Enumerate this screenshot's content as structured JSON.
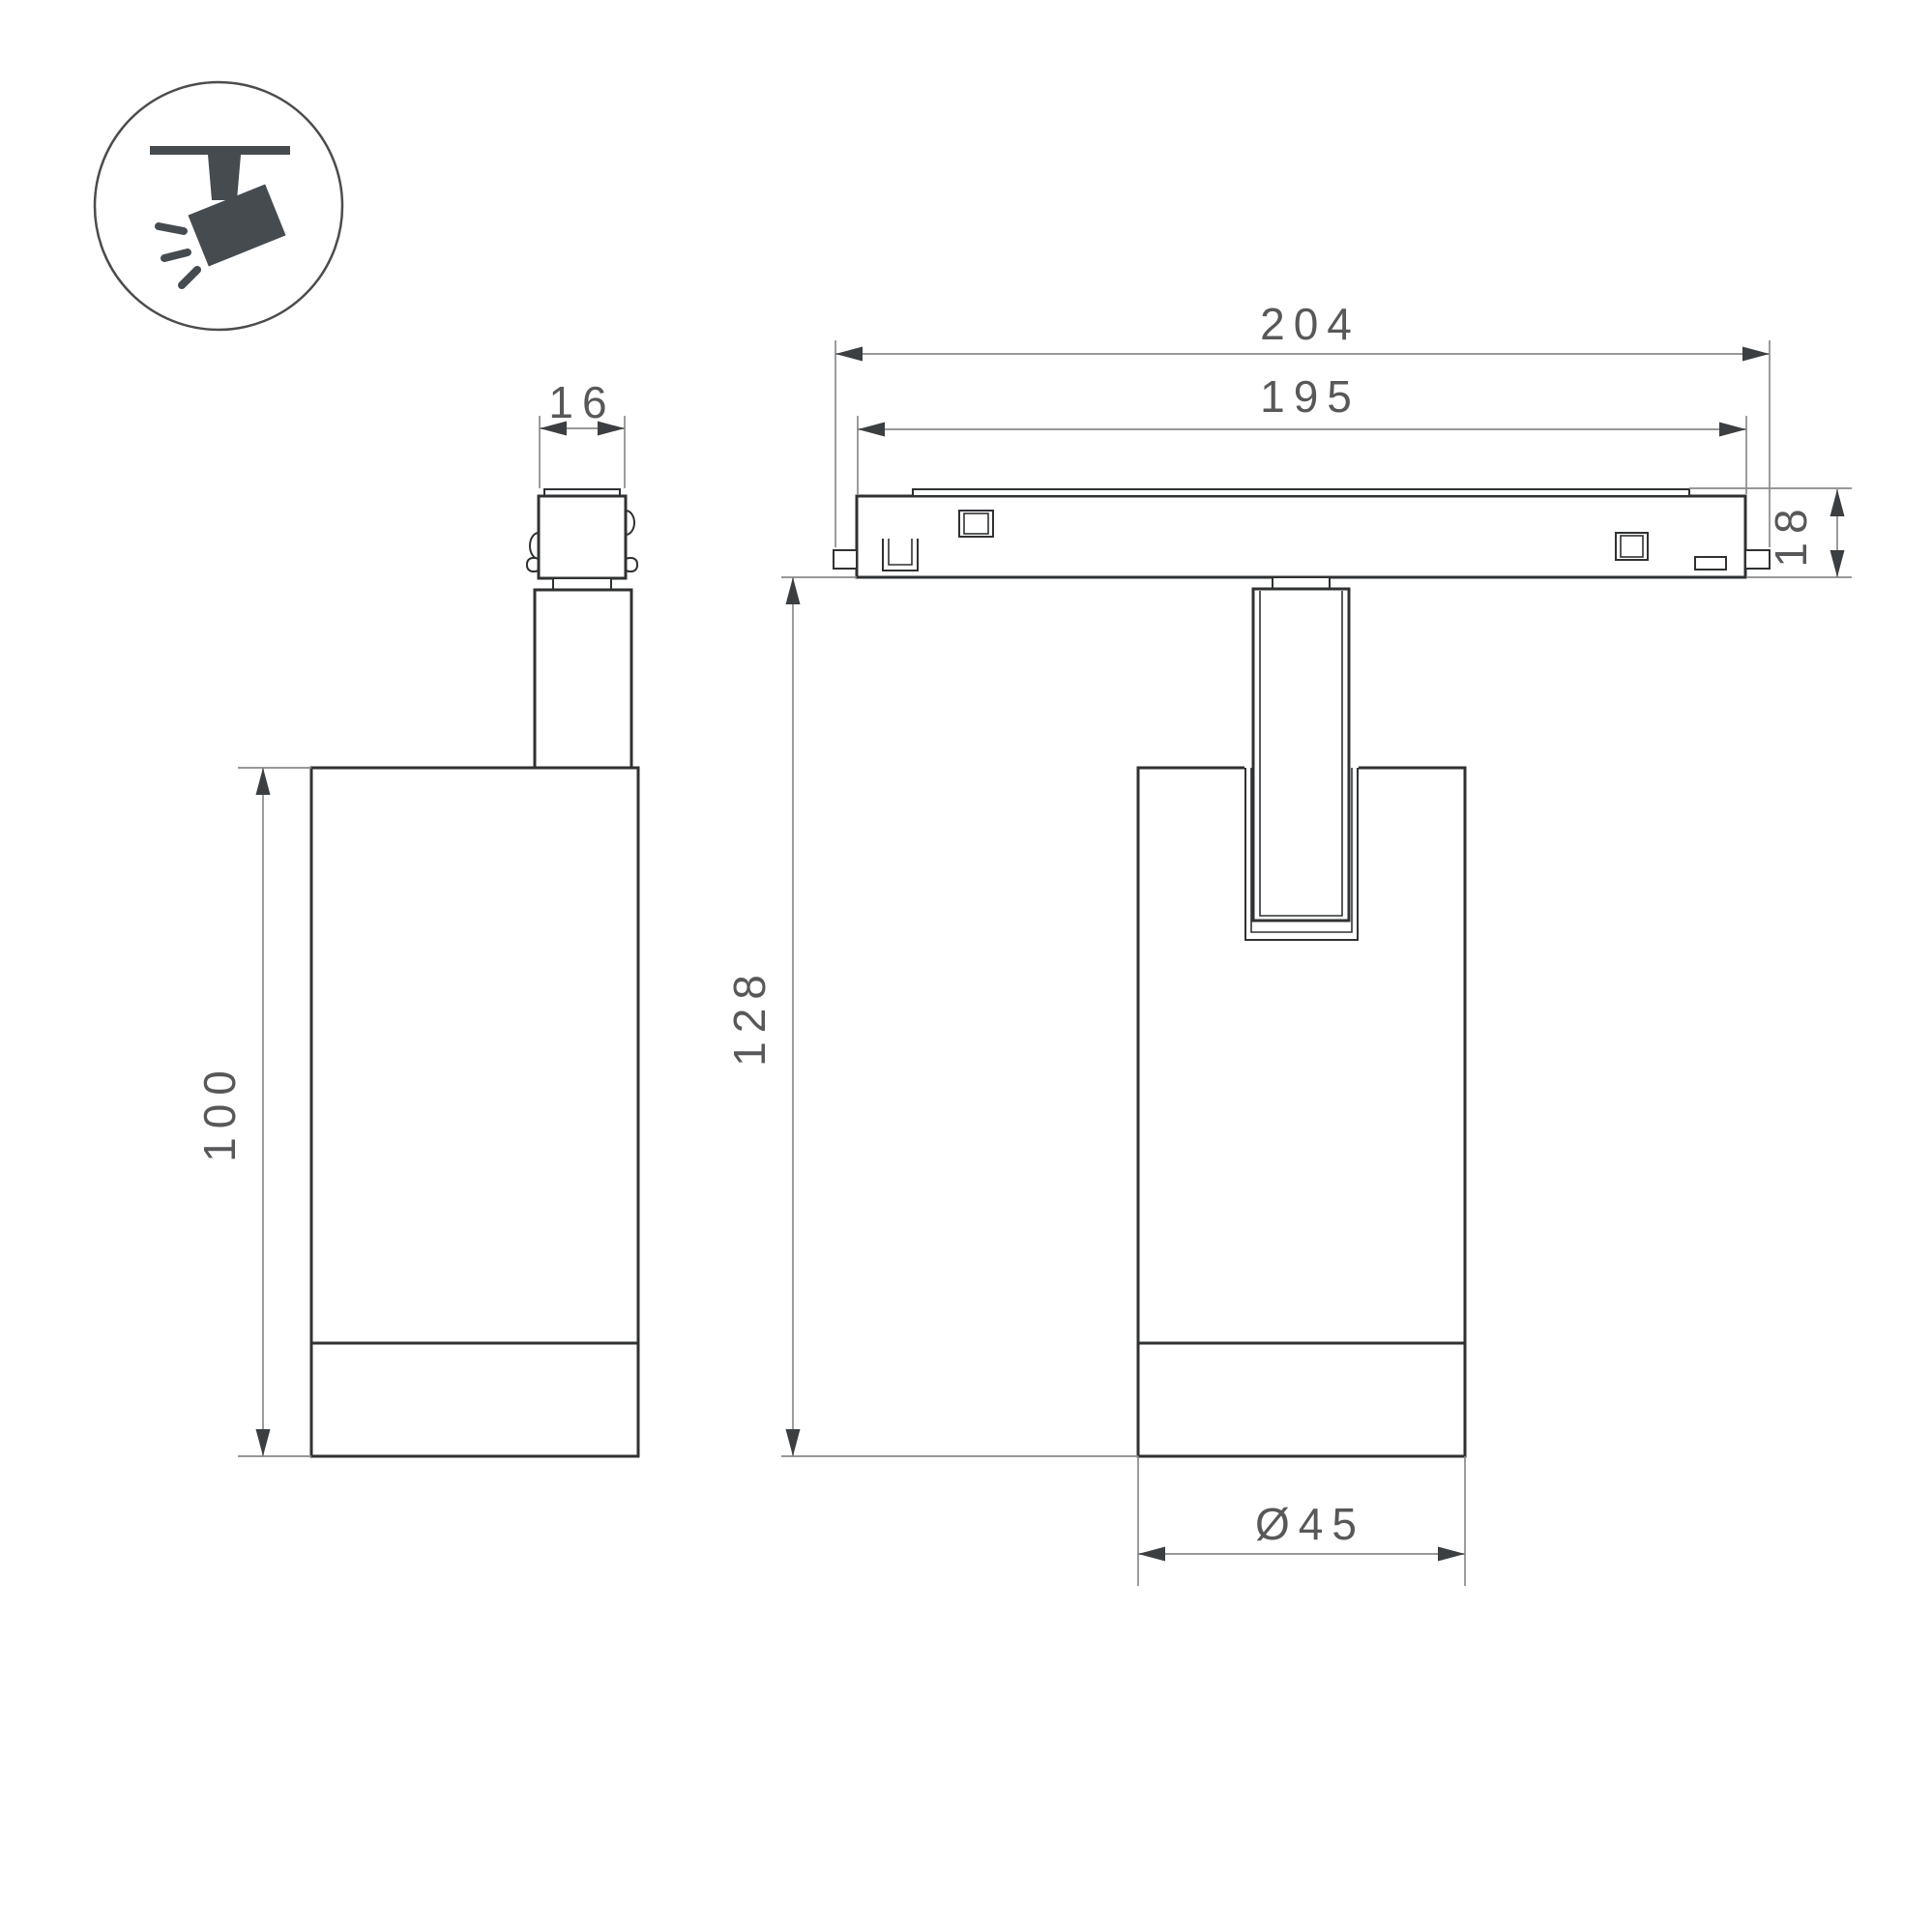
{
  "icon": {
    "name": "track-spotlight-icon",
    "description": "ceiling track with tilted spotlight emitting rays"
  },
  "dimensions": {
    "side_view": {
      "adapter_width": "16",
      "body_height": "100"
    },
    "front_view": {
      "track_overall_length": "204",
      "track_body_length": "195",
      "track_height": "18",
      "overall_height": "128",
      "body_diameter": "Ø45"
    }
  },
  "colors": {
    "background": "#ffffff",
    "outline": "#2f3133",
    "dimension_line": "#8a8a8a",
    "arrow": "#3c3f41",
    "text": "#58585a",
    "icon_glyph": "#464b50",
    "icon_circle": "#4c4c4c"
  }
}
